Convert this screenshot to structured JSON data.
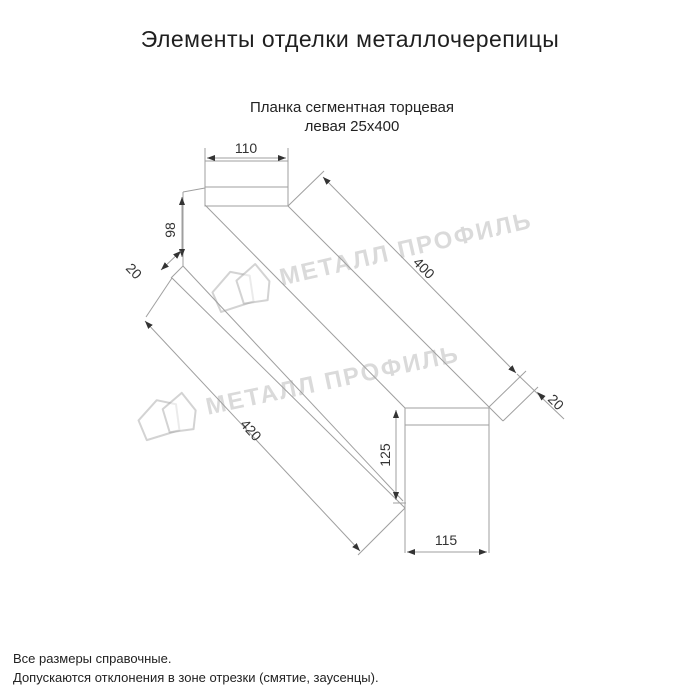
{
  "header": {
    "title": "Элементы отделки металлочерепицы"
  },
  "product": {
    "name_line1": "Планка сегментная торцевая",
    "name_line2": "левая 25х400"
  },
  "dimensions": {
    "cap_width": "110",
    "face_height": "98",
    "near_hem": "20",
    "length_top": "400",
    "far_hem": "20",
    "length_bottom": "420",
    "end_height": "125",
    "end_width": "115"
  },
  "watermark": {
    "brand": "МЕТАЛЛ ПРОФИЛЬ"
  },
  "footer": {
    "note1": "Все размеры справочные.",
    "note2": "Допускаются отклонения в зоне отрезки (смятие, заусенцы)."
  },
  "colors": {
    "line": "#9f9f9f",
    "dim_text": "#333333",
    "arrow": "#333333",
    "watermark": "#9e9e9e",
    "title_text": "#1f1f1f"
  }
}
